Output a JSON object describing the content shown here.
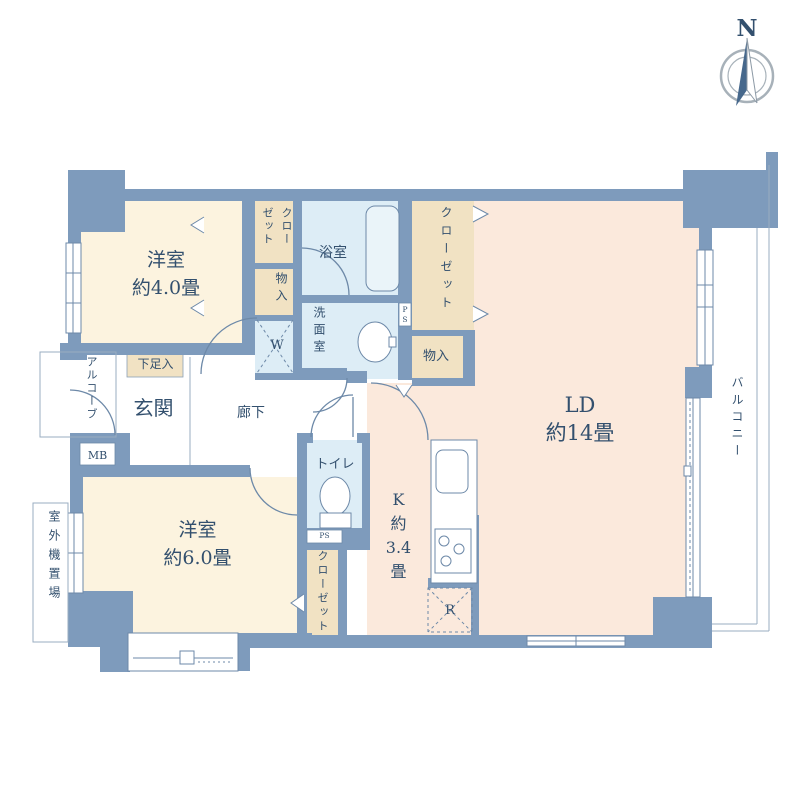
{
  "title": "apartment-floor-plan",
  "compass": {
    "north_label": "N"
  },
  "labels": {
    "western_room_1": "洋室\n約4.0畳",
    "western_room_2": "洋室\n約6.0畳",
    "living_dining": "LD\n約14畳",
    "kitchen": "K\n約\n3.4\n畳",
    "bath": "浴室",
    "washroom": "洗面室",
    "toilet": "トイレ",
    "entrance": "玄関",
    "hallway": "廊下",
    "closet_north": "クローゼット",
    "closet_east": "クローゼット",
    "closet_south": "クローゼット",
    "storage_west": "物入",
    "storage_east": "物入",
    "shoe_cabinet": "下足入",
    "washer_space": "W",
    "meter_box": "MB",
    "alcove": "アルコーブ",
    "outdoor_unit_space": "室外機置場",
    "balcony": "バルコニー",
    "refrigerator_space": "R",
    "pipe_space_east": "P\nS",
    "pipe_space_south": "PS"
  },
  "colors": {
    "wall": "#7e9bbc",
    "room_cream": "#fcf3df",
    "room_peach": "#fbe9dc",
    "closet_tan": "#f1e2c3",
    "wet_area_blue": "#ddedf6",
    "fixture_line": "#6d89a8",
    "thin_line": "#9aacc0",
    "text": "#33506e",
    "compass_ring": "#a7b1b9",
    "compass_arrow": "#46688c"
  }
}
